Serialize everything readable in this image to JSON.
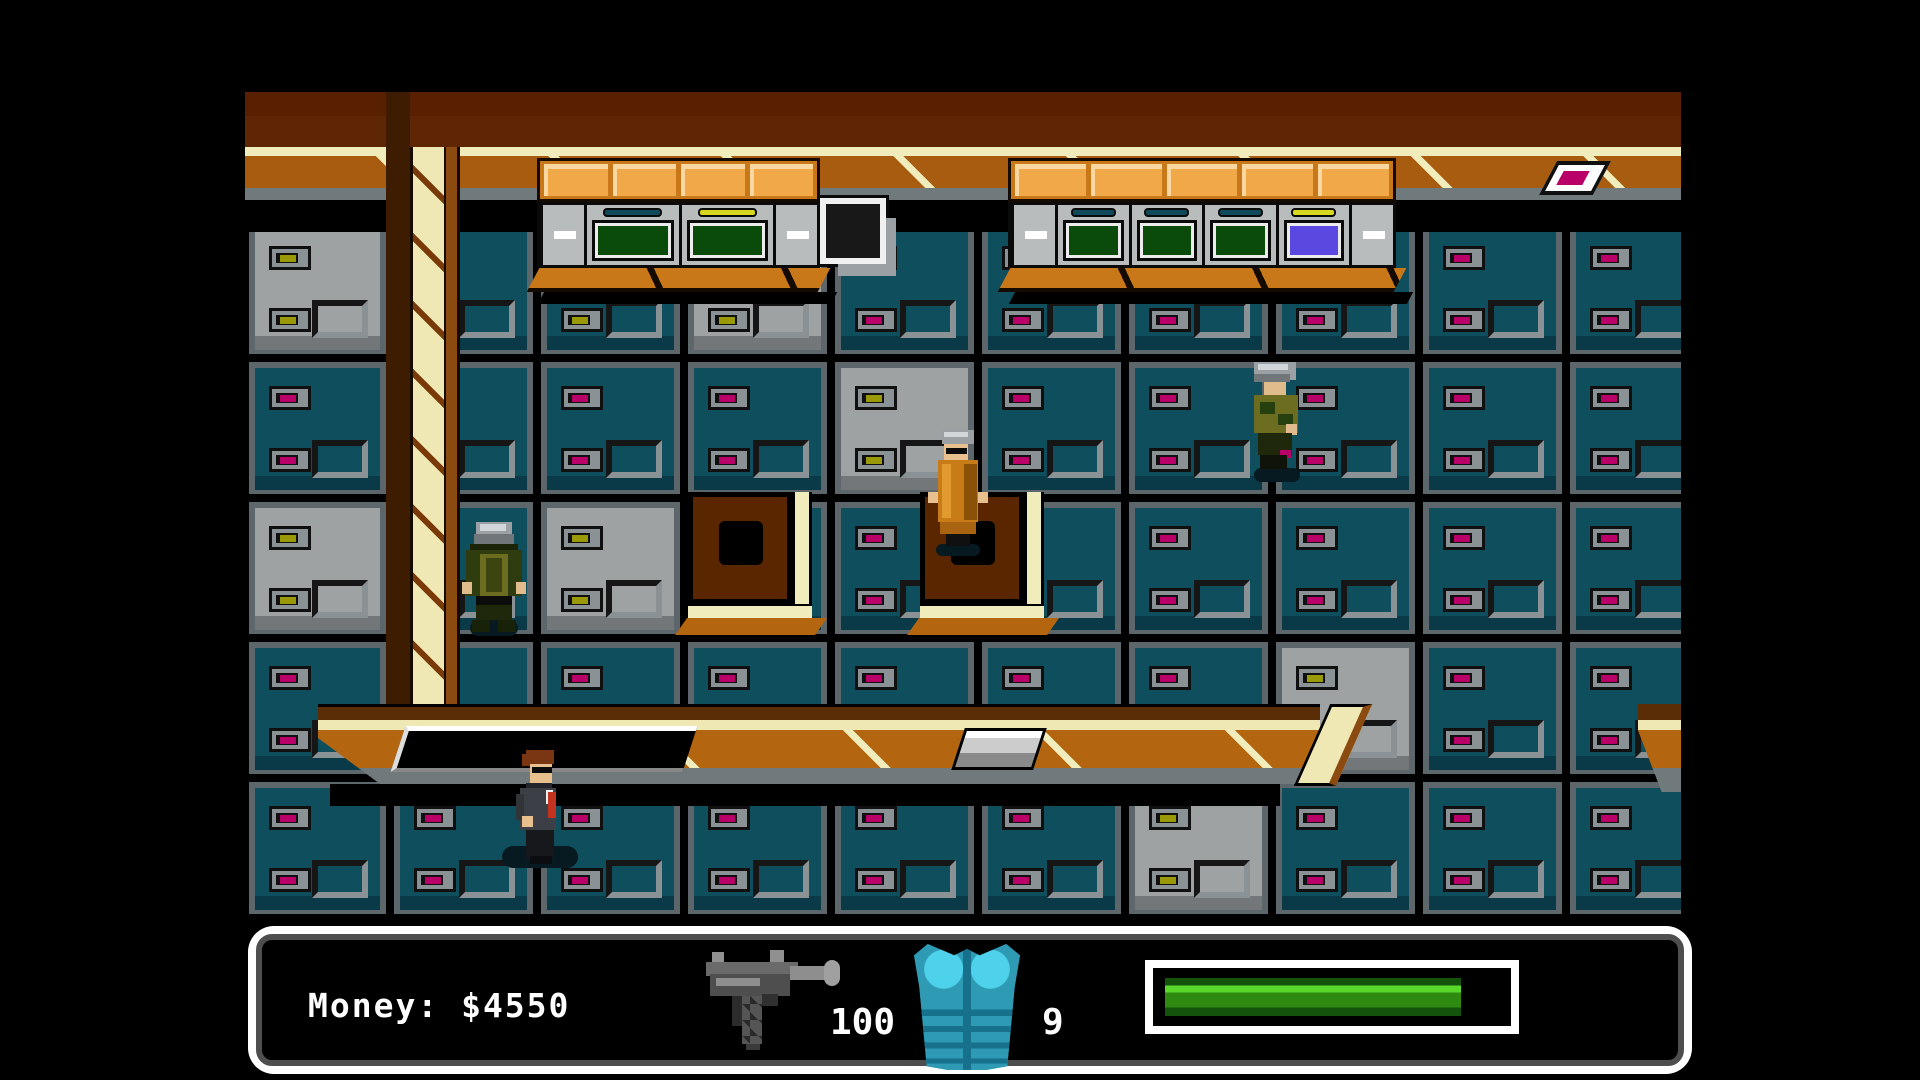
{
  "hud": {
    "money_text": "Money: $4550",
    "ammo_count": "100",
    "armor_count": "9",
    "weapon_icon": "uzi-icon",
    "armor_icon": "body-armor-icon",
    "health": {
      "percent_green": 88.5,
      "green_dark": "#14530c",
      "green_bright": "#58d82a",
      "green_mid": "#2e8a10",
      "red_dark": "#5c0a00",
      "red_bright": "#e04028",
      "red_mid": "#c23420"
    },
    "panel": {
      "border": "#ffffff",
      "inner_line": "#4e4e4e",
      "bg": "#000000",
      "text_color": "#ffffff"
    },
    "armor_colors": {
      "base": "#2e9ab4",
      "highlight": "#4ed2ec",
      "dark": "#17708c"
    }
  },
  "scene": {
    "palette": {
      "teal": "#0f4e5d",
      "teal_dark": "#0a3a47",
      "gray": "#9ea2a2",
      "gray_dark": "#73777a",
      "frame": "#5d666a",
      "handle_case": "#8a9296",
      "handle_olive": "#9a9a08",
      "handle_magenta": "#b80068",
      "band_brown": "#5e2604",
      "checker_brown": "#581f00",
      "cream": "#f0ecbc",
      "ledge_orange": "#a85c10",
      "ledge_gray": "#70797c",
      "beam_cream": "#f0e8b4",
      "beam_stripe": "#7a3a08",
      "beam_side": "#8a4a10",
      "beam_shadow": "#3d1c02",
      "machine_body": "#b8bcbc",
      "screen_green_bg": "#0a4a0a",
      "screen_green_hi": "#2f8f17",
      "screen_purple_bg": "#5a48e0",
      "screen_purple_hi": "#9a8af8",
      "slot_teal": "#0e4a5a",
      "slot_yellow": "#d8d820",
      "panel_orange": "#f0a848",
      "panel_orange_hi": "#f8d8a0",
      "panel_orange_bg": "#c87818",
      "sill_orange": "#c87818",
      "vent_brown": "#5a2600",
      "walk_brown": "#5a2d06",
      "walk_orange": "#b4650f",
      "skin": "#e8c08e",
      "skin2": "#e0bb8c",
      "hair_brown": "#7a3512",
      "suit_gray": "#3c4046",
      "suit_dark": "#17181c",
      "tie_red": "#c23420",
      "shirt_white": "#f0f0f0",
      "helmet_gray": "#9aa0a4",
      "helmet_hi": "#d2d6d8",
      "soldier_jacket": "#2e3c10",
      "soldier_vest": "#6d6d22",
      "soldier_pants": "#20280c",
      "robe_orange": "#c87c17",
      "robe_dark": "#8a5208",
      "robe_hi": "#e09a2e",
      "shadow_blob": "#071a21",
      "black": "#000000"
    },
    "lockers": {
      "rows": [
        {
          "cells": [
            "g",
            "to",
            "to",
            "g",
            "t",
            "t",
            "t",
            "t",
            "t",
            "t"
          ]
        },
        {
          "cells": [
            "t",
            "t",
            "t",
            "t",
            "g",
            "t",
            "t",
            "t",
            "t",
            "t"
          ]
        },
        {
          "cells": [
            "g",
            "t",
            "g",
            "t",
            "t",
            "t",
            "t",
            "t",
            "t",
            "t"
          ]
        },
        {
          "cells": [
            "t",
            "t",
            "t",
            "t",
            "t",
            "t",
            "t",
            "g",
            "t",
            "t"
          ]
        },
        {
          "cells": [
            "t",
            "t",
            "t",
            "t",
            "t",
            "t",
            "g",
            "t",
            "t",
            "t"
          ]
        }
      ],
      "legend": {
        "t": "teal-locker",
        "g": "gray-locker",
        "to": "teal-locker-olive-handles"
      }
    },
    "machines": {
      "left_bank": {
        "panels": 4,
        "screens": [
          "green",
          "green"
        ],
        "slots": [
          "teal",
          "yellow"
        ]
      },
      "right_bank": {
        "panels": 5,
        "screens": [
          "green",
          "green",
          "green",
          "purple"
        ],
        "slots": [
          "teal",
          "teal",
          "teal",
          "yellow"
        ]
      }
    },
    "props": [
      "speaker-box",
      "ledge-paper",
      "wall-vent-left",
      "wall-vent-right",
      "walkway-hatch",
      "walkway-trapdoor",
      "support-beam",
      "upper-ledge",
      "lower-walkway"
    ],
    "characters": [
      {
        "id": "soldier-back",
        "desc": "helmeted soldier facing away"
      },
      {
        "id": "agent-orange",
        "desc": "figure in orange coat with gray cap and visor"
      },
      {
        "id": "soldier-profile",
        "desc": "helmeted soldier facing right"
      },
      {
        "id": "player-suit",
        "desc": "agent in dark suit with red tie"
      }
    ]
  }
}
